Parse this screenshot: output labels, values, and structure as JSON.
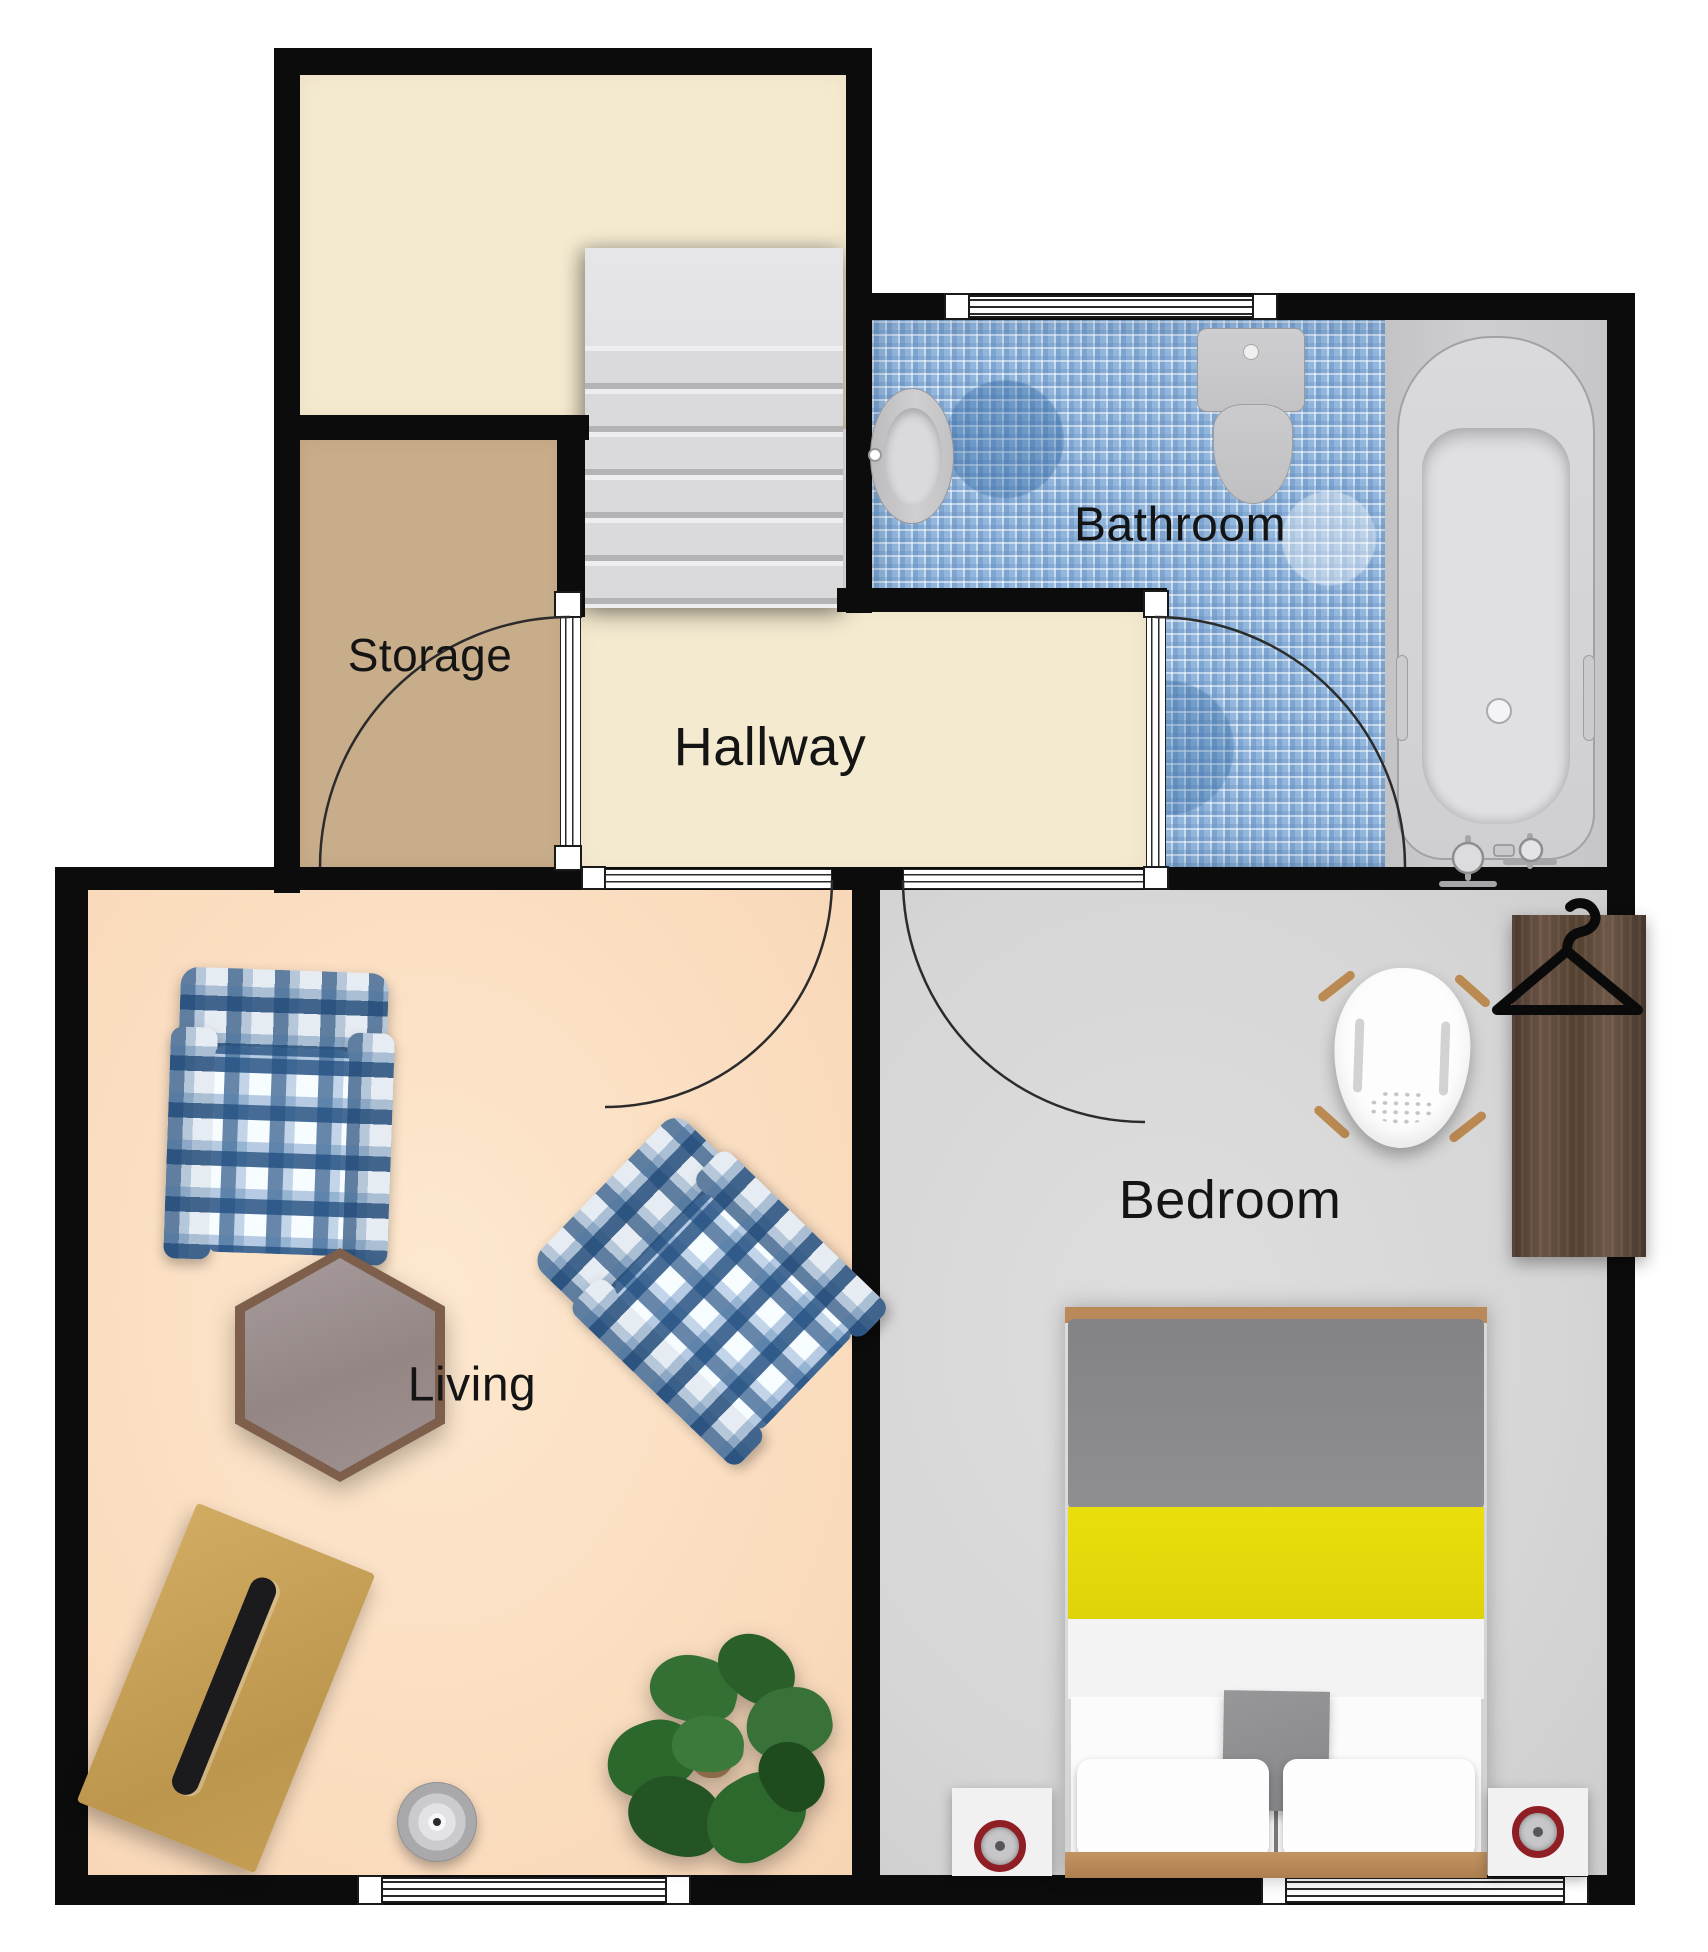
{
  "plan_title": "Floor plan",
  "rooms": [
    {
      "id": "storage",
      "label": "Storage",
      "floor_color": "#c8ad8b"
    },
    {
      "id": "hallway",
      "label": "Hallway",
      "floor_color": "#f4ead0"
    },
    {
      "id": "bathroom",
      "label": "Bathroom",
      "floor_color": "#93b7dc"
    },
    {
      "id": "living",
      "label": "Living",
      "floor_color": "#fadcbe"
    },
    {
      "id": "bedroom",
      "label": "Bedroom",
      "floor_color": "#d8d8d8"
    },
    {
      "id": "upper-room",
      "label": "",
      "floor_color": "#f4ead0"
    }
  ],
  "colors": {
    "wall": "#0c0c0c",
    "stairs": "#d9d9db",
    "bathroom_tile_base": "#93b7dc",
    "bed_accent_yellow": "#e6da0a",
    "bed_duvet_grey": "#8b8b8d",
    "wood_dark": "#5a4539",
    "wood_light": "#c9a055",
    "plaid_blue": "#2a527e",
    "clock_ring_red": "#8f1f24",
    "plant_green": "#2f6e2f"
  },
  "fixtures": [
    "stairs",
    "bathtub",
    "toilet",
    "sink",
    "bathroom-window",
    "double-bed",
    "nightstand-left",
    "nightstand-right",
    "alarm-clock-left",
    "alarm-clock-right",
    "wardrobe",
    "clothes-hanger-icon",
    "desk-chair",
    "bedroom-window",
    "armchair-plaid-1",
    "armchair-plaid-2",
    "hexagon-coffee-table",
    "desk",
    "laptop",
    "round-speaker",
    "potted-plant",
    "living-window",
    "storage-door",
    "living-door",
    "bedroom-door",
    "bathroom-door"
  ]
}
